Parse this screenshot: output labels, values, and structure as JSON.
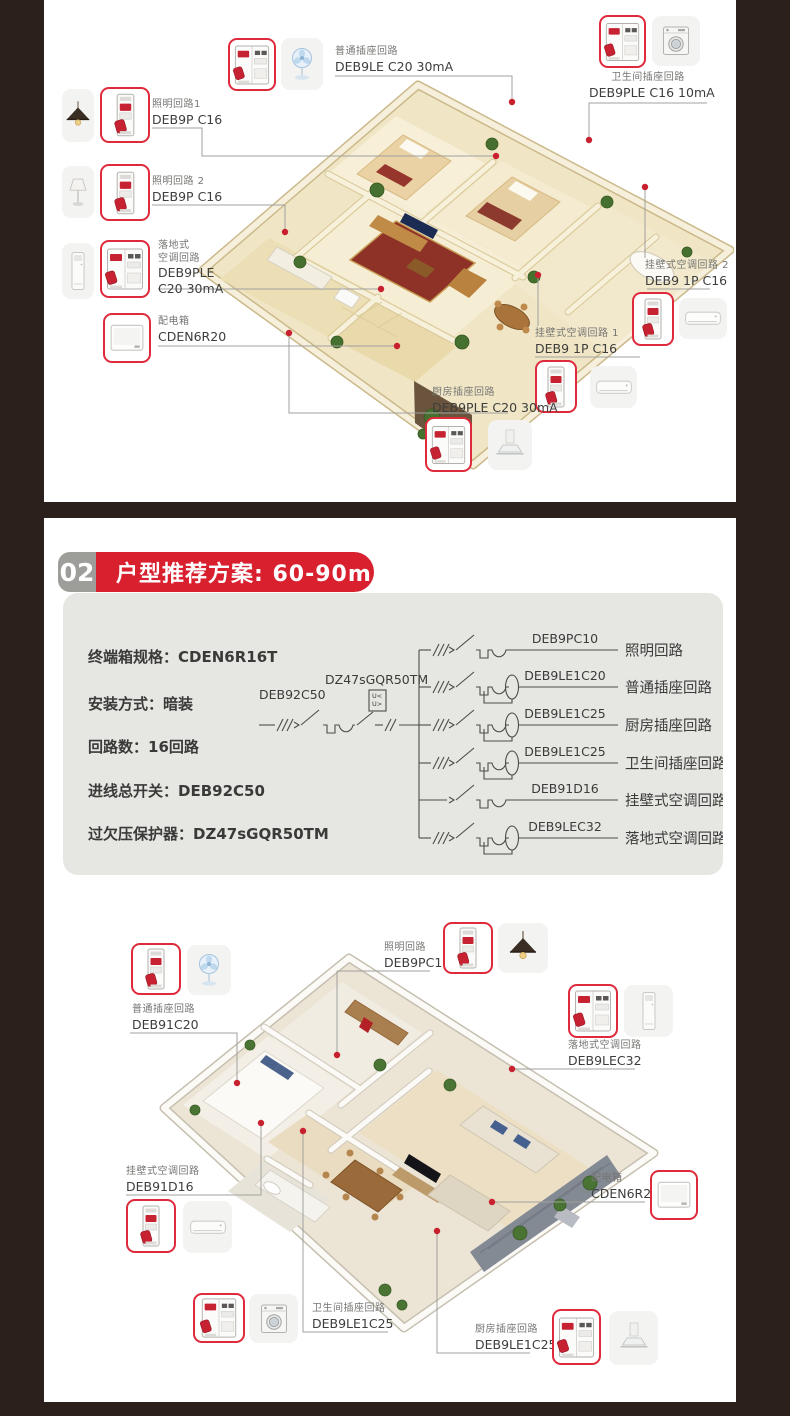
{
  "colors": {
    "page_bg": "#2b201b",
    "panel_bg": "#ffffff",
    "accent_red": "#d8202f",
    "breaker_border_red": "#df2a3c",
    "badge_gray": "#9d9d9a",
    "gray_panel": "#e6e6e3",
    "connector_line": "#a0a09e",
    "dot_red": "#c8202e",
    "text_dark": "#3a3a38",
    "text_gray": "#757573"
  },
  "top_section": {
    "callouts": {
      "normal_socket": {
        "name": "普通插座回路",
        "model": "DEB9LE C20 30mA"
      },
      "lighting_1": {
        "name": "照明回路1",
        "model": "DEB9P C16"
      },
      "lighting_2": {
        "name": "照明回路 2",
        "model": "DEB9P C16"
      },
      "floor_ac": {
        "name_line1": "落地式",
        "name_line2": "空调回路",
        "model_line1": "DEB9PLE",
        "model_line2": "C20 30mA"
      },
      "distribution_box": {
        "name": "配电箱",
        "model": "CDEN6R20"
      },
      "bathroom_socket": {
        "name": "卫生间插座回路",
        "model": "DEB9PLE C16 10mA"
      },
      "wall_ac_2": {
        "name": "挂壁式空调回路 2",
        "model": "DEB9 1P C16"
      },
      "wall_ac_1": {
        "name": "挂壁式空调回路 1",
        "model": "DEB9 1P C16"
      },
      "kitchen_socket": {
        "name": "厨房插座回路",
        "model": "DEB9PLE C20 30mA"
      }
    }
  },
  "plan_section": {
    "badge_number": "02",
    "title": "户型推荐方案: 60-90m",
    "title_superscript": "2",
    "specs": [
      {
        "label": "终端箱规格：",
        "value": "CDEN6R16T"
      },
      {
        "label": "安装方式：",
        "value": "暗装"
      },
      {
        "label": "回路数：",
        "value": "16回路"
      },
      {
        "label": "进线总开关：",
        "value": "DEB92C50"
      },
      {
        "label": "过欠压保护器：",
        "value": "DZ47sGQR50TM"
      }
    ],
    "diagram": {
      "main_breaker_model": "DEB92C50",
      "protector_model": "DZ47sGQR50TM",
      "protector_symbol_top": "U<",
      "protector_symbol_bottom": "U>",
      "branches": [
        {
          "model": "DEB9PC10",
          "circuit": "照明回路"
        },
        {
          "model": "DEB9LE1C20",
          "circuit": "普通插座回路"
        },
        {
          "model": "DEB9LE1C25",
          "circuit": "厨房插座回路"
        },
        {
          "model": "DEB9LE1C25",
          "circuit": "卫生间插座回路"
        },
        {
          "model": "DEB91D16",
          "circuit": "挂壁式空调回路"
        },
        {
          "model": "DEB9LEC32",
          "circuit": "落地式空调回路"
        }
      ]
    },
    "callouts": {
      "normal_socket": {
        "name": "普通插座回路",
        "model": "DEB91C20"
      },
      "lighting": {
        "name": "照明回路",
        "model": "DEB9PC10"
      },
      "floor_ac": {
        "name": "落地式空调回路",
        "model": "DEB9LEC32"
      },
      "distribution_box": {
        "name": "配电箱",
        "model": "CDEN6R20"
      },
      "wall_ac": {
        "name": "挂壁式空调回路",
        "model": "DEB91D16"
      },
      "bathroom_socket": {
        "name": "卫生间插座回路",
        "model": "DEB9LE1C25"
      },
      "kitchen_socket": {
        "name": "厨房插座回路",
        "model": "DEB9LE1C25"
      }
    }
  },
  "icons": {
    "breaker_1p": "miniature circuit breaker, 1 module, red toggle",
    "breaker_2p": "residual-current circuit breaker, 2 modules, red toggle",
    "fan": "stand fan",
    "pendant_lamp": "pendant ceiling lamp",
    "table_lamp": "table lamp",
    "floor_ac": "floor-standing air conditioner",
    "wall_ac": "wall-mounted air conditioner",
    "washing_machine": "washing machine",
    "range_hood": "kitchen range hood",
    "distribution_box": "distribution box panel"
  }
}
